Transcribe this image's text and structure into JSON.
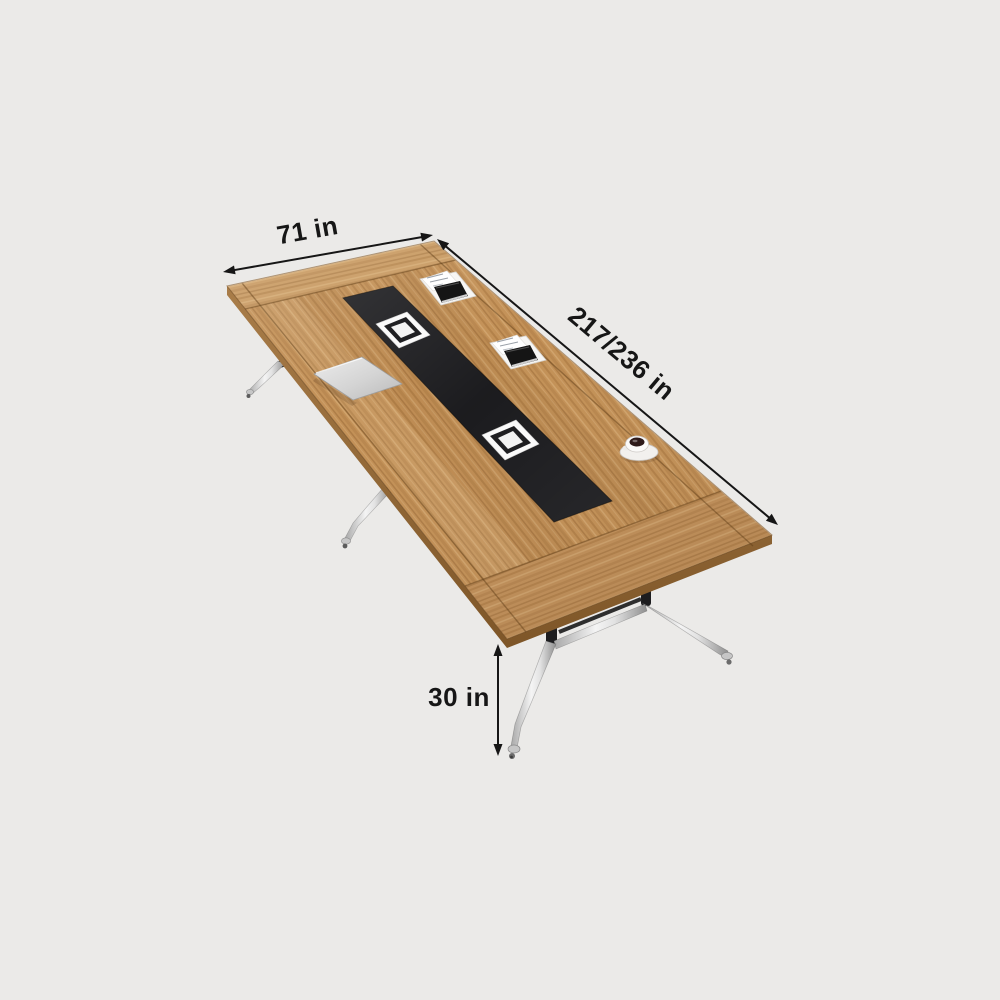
{
  "canvas": {
    "width": 1000,
    "height": 1000,
    "background": "#EBEAE8"
  },
  "dimension_labels": {
    "width": "71 in",
    "length": "217/236 in",
    "height": "30 in"
  },
  "colors": {
    "background": "#EBEAE8",
    "wood_base": "#C39157",
    "wood_border": "#C99B63",
    "wood_edge_band": "#8F6535",
    "cable_channel": "#17171A",
    "grommet_white": "#FAFAFA",
    "chrome_leg": "#D9D9D9",
    "leg_joint_black": "#1D1D1F",
    "annotation_ink": "#161616"
  },
  "scene_items": [
    "table-top",
    "cable-channel",
    "cable-grommet",
    "power-module",
    "notebook",
    "coffee-cup",
    "table-leg-assembly"
  ]
}
